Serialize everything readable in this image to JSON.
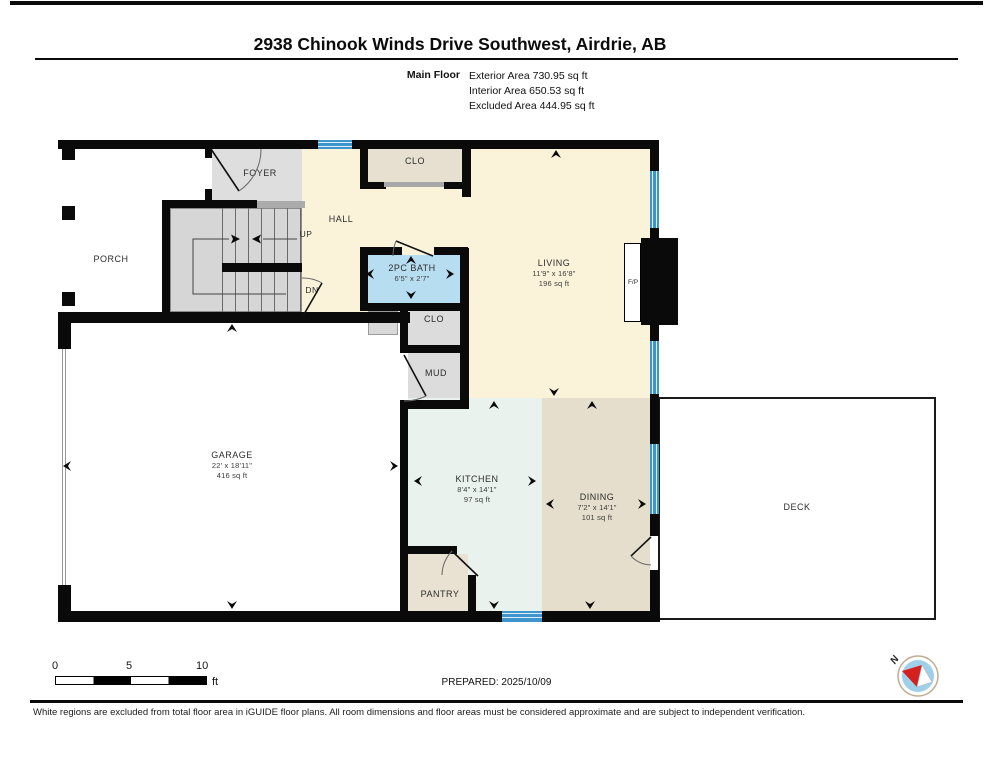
{
  "header": {
    "title": "2938 Chinook Winds Drive Southwest, Airdrie, AB",
    "floor_label": "Main Floor",
    "exterior_area": "Exterior Area 730.95 sq ft",
    "interior_area": "Interior Area 650.53 sq ft",
    "excluded_area": "Excluded Area 444.95 sq ft"
  },
  "rooms": {
    "porch": {
      "name": "PORCH"
    },
    "foyer": {
      "name": "FOYER"
    },
    "hall": {
      "name": "HALL"
    },
    "closet_top": {
      "name": "CLO"
    },
    "bath": {
      "name": "2PC BATH",
      "dims": "6'5\" x 2'7\""
    },
    "closet_lower": {
      "name": "CLO"
    },
    "mud": {
      "name": "MUD"
    },
    "living": {
      "name": "LIVING",
      "dims": "11'9\" x 16'8\"",
      "area": "196 sq ft"
    },
    "garage": {
      "name": "GARAGE",
      "dims": "22' x 18'11\"",
      "area": "416 sq ft"
    },
    "kitchen": {
      "name": "KITCHEN",
      "dims": "8'4\" x 14'1\"",
      "area": "97 sq ft"
    },
    "dining": {
      "name": "DINING",
      "dims": "7'2\" x 14'1\"",
      "area": "101 sq ft"
    },
    "pantry": {
      "name": "PANTRY"
    },
    "deck": {
      "name": "DECK"
    },
    "fireplace": {
      "name": "F/P"
    }
  },
  "stairs": {
    "up_label": "UP",
    "down_label": "DN"
  },
  "scale_bar": {
    "tick0": "0",
    "tick5": "5",
    "tick10": "10",
    "unit": "ft"
  },
  "compass": {
    "north_label": "N"
  },
  "footer": {
    "prepared": "PREPARED: 2025/10/09",
    "disclaimer": "White regions are excluded from total floor area in iGUIDE floor plans. All room dimensions and floor areas must be considered approximate and are subject to independent verification."
  },
  "colors": {
    "wall": "#0a0a0a",
    "window_blue": "#3e95cd",
    "bath_blue": "#b7ddf1",
    "floor_cream": "#faf3da",
    "floor_tan": "#e6decc",
    "floor_gray": "#dcdcdc",
    "kitchen_mint": "#e9f2ec",
    "compass_blue": "#9ed0ea",
    "needle_red": "#d61f1f"
  }
}
